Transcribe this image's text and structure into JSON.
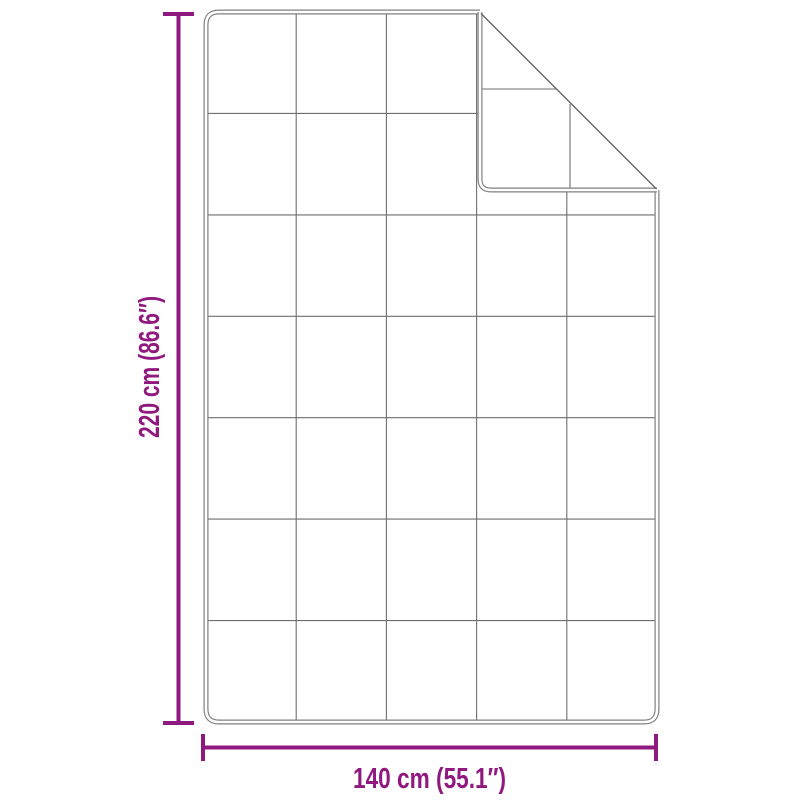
{
  "diagram": {
    "height_label": "220 cm (86.6″)",
    "width_label": "140 cm (55.1″)",
    "quilt_grid": {
      "columns": 5,
      "rows": 7
    },
    "folded_corner": "top-right",
    "colors": {
      "dimension": "#90197f",
      "outline": "#7f7f7f",
      "grid_line": "#6e6e6e",
      "crease": "#666666",
      "background": "#ffffff"
    }
  }
}
